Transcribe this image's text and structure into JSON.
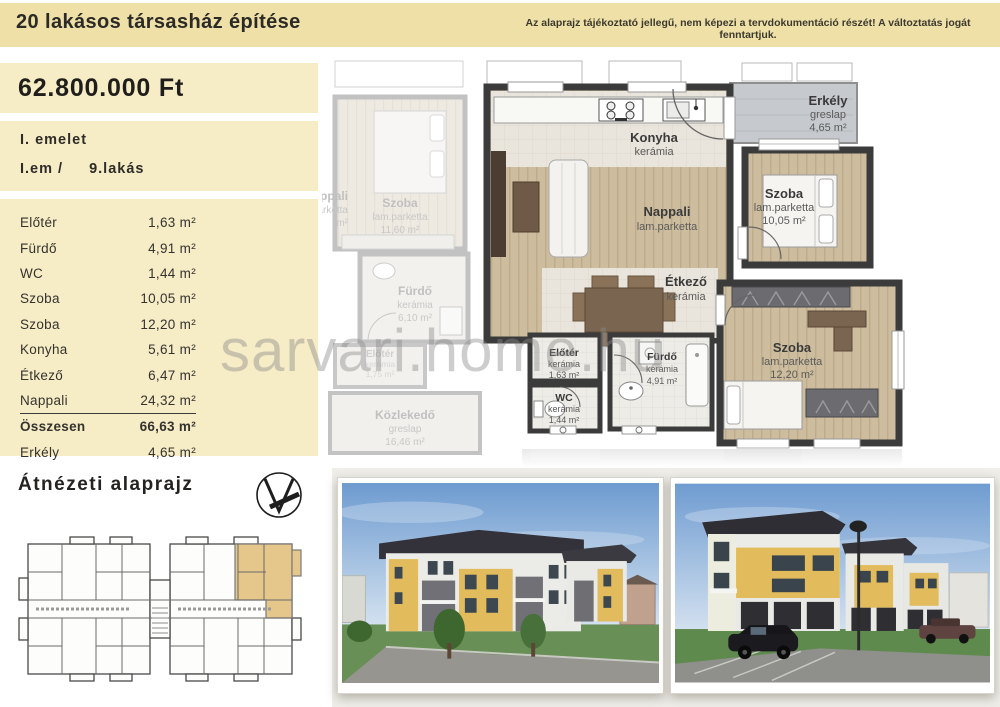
{
  "header": {
    "title": "20 lakásos társasház építése",
    "disclaimer": "Az alaprajz tájékoztató jellegű, nem képezi a tervdokumentáció részét! A változtatás jogát fenntartjuk."
  },
  "sidebar": {
    "price": "62.800.000 Ft",
    "floor_label": "I. emelet",
    "unit_label": "I.em /",
    "unit_number": "9.lakás",
    "rows": [
      {
        "name": "Előtér",
        "area": "1,63 m²"
      },
      {
        "name": "Fürdő",
        "area": "4,91 m²"
      },
      {
        "name": "WC",
        "area": "1,44 m²"
      },
      {
        "name": "Szoba",
        "area": "10,05 m²"
      },
      {
        "name": "Szoba",
        "area": "12,20 m²"
      },
      {
        "name": "Konyha",
        "area": "5,61 m²"
      },
      {
        "name": "Étkező",
        "area": "6,47 m²"
      },
      {
        "name": "Nappali",
        "area": "24,32 m²"
      },
      {
        "name": "Összesen",
        "area": "66,63 m²"
      },
      {
        "name": "Erkély",
        "area": "4,65 m²"
      }
    ]
  },
  "overview": {
    "title": "Átnézeti alaprajz"
  },
  "floorplan": {
    "konyha": {
      "name": "Konyha",
      "material": "kerámia"
    },
    "nappali": {
      "name": "Nappali",
      "material": "lam.parketta"
    },
    "erkely": {
      "name": "Erkély",
      "material": "greslap",
      "area": "4,65 m²"
    },
    "szoba1": {
      "name": "Szoba",
      "material": "lam.parketta",
      "area": "10,05 m²"
    },
    "etkezo": {
      "name": "Étkező",
      "material": "kerámia"
    },
    "szoba2": {
      "name": "Szoba",
      "material": "lam.parketta",
      "area": "12,20 m²"
    },
    "eloter": {
      "name": "Előtér",
      "material": "kerámia",
      "area": "1,63 m²"
    },
    "furdo": {
      "name": "Fürdő",
      "material": "kerámia",
      "area": "4,91 m²"
    },
    "wc": {
      "name": "WC",
      "material": "kerámia",
      "area": "1,44 m²"
    },
    "adj_szoba": {
      "name": "Szoba",
      "material": "lam.parketta",
      "area": "11,60 m²"
    },
    "adj_furdo": {
      "name": "Fürdő",
      "material": "kerámia",
      "area": "6,10 m²"
    },
    "adj_eloter": {
      "name": "Előtér",
      "material": "kerámia",
      "area": "1,75 m²"
    },
    "adj_nappali": {
      "name": "Nappali",
      "material": "lam.parketta",
      "area": "m²"
    },
    "kozlekedo": {
      "name": "Közlekedő",
      "material": "greslap",
      "area": "16,46 m²"
    }
  },
  "watermark": "sarvari.home.hu",
  "colors": {
    "header_bg": "#eee0a6",
    "panel_bg": "#f6ecc6",
    "wall": "#3b3b3b",
    "wood": "#cdbd9e",
    "tile": "#eae5dc",
    "balcony": "#c6c9cd",
    "highlight": "#e5c78b"
  }
}
